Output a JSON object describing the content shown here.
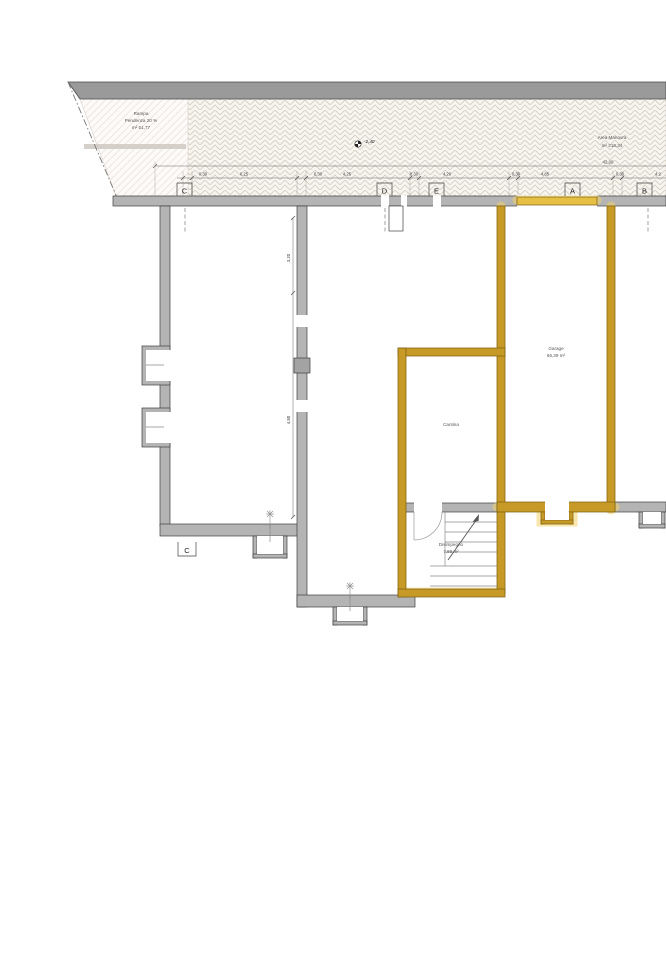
{
  "drawing": {
    "site": {
      "rampa": {
        "name": "Rampa",
        "slope": "Pendenza 20 %",
        "area": "m² 51,77"
      },
      "area_manovra": {
        "name": "Area Manovra",
        "area": "m² 218,34"
      },
      "level_marker": "-2,40"
    },
    "rooms": {
      "garage": {
        "name": "Garage",
        "area": "66,39 m²"
      },
      "cantina": {
        "name": "Cantina"
      },
      "disimpegno": {
        "name": "Disimpegno",
        "area": "7,89 m²"
      }
    },
    "dimensions": {
      "overall": "42,00",
      "horizontal": [
        "0,30",
        "6,25",
        "0,30",
        "4,25",
        "0,30",
        "4,20",
        "0,30",
        "4,85",
        "0,30",
        "4,2"
      ],
      "vertical": [
        "3,20",
        "4,80"
      ]
    },
    "section_markers": {
      "top": [
        "C",
        "D",
        "E",
        "A",
        "B"
      ],
      "bottom": [
        "C"
      ]
    },
    "colors": {
      "highlight_wall": "#C79A28",
      "highlight_glow": "#F2D268",
      "wall_gray": "#B4B4B4",
      "retaining_wall": "#9A9A9A"
    }
  }
}
